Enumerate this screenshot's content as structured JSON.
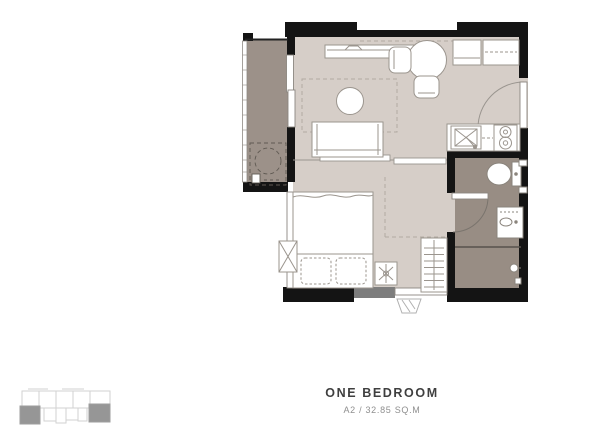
{
  "title_block": {
    "title": "ONE BEDROOM",
    "subtitle": "A2 / 32.85 SQ.M"
  },
  "colors": {
    "background": "#ffffff",
    "floor": "#d6cec8",
    "balcony_floor": "#9c9189",
    "bathroom_floor": "#988d84",
    "wall": "#141414",
    "wall_gray_segment": "#7d7d7d",
    "furniture_outline": "#9b958e",
    "dashed_guides": "#b1aaa2",
    "keyplan_outline": "#d2d2d2",
    "keyplan_unit_highlight": "#969696",
    "title_text": "#3f3f3f",
    "subtitle_text": "#8f8f8f"
  },
  "floor_plan": {
    "unit_features": [
      "balcony",
      "washing-machine",
      "sliding-balcony-door",
      "tv-console",
      "dining-table",
      "dining-chairs",
      "overhead-cabinets",
      "coffee-table",
      "sofa",
      "sliding-room-partition",
      "bed",
      "pillows",
      "ceiling-fan-symbol",
      "side-window",
      "wardrobe",
      "kitchen-counter",
      "kitchen-sink",
      "stove",
      "entrance-door",
      "bathroom-door",
      "toilet",
      "vanity-sink",
      "shower-area",
      "shower-head",
      "floor-drain",
      "ac-condenser-unit"
    ]
  },
  "key_plan": {
    "highlighted_units": 2
  }
}
